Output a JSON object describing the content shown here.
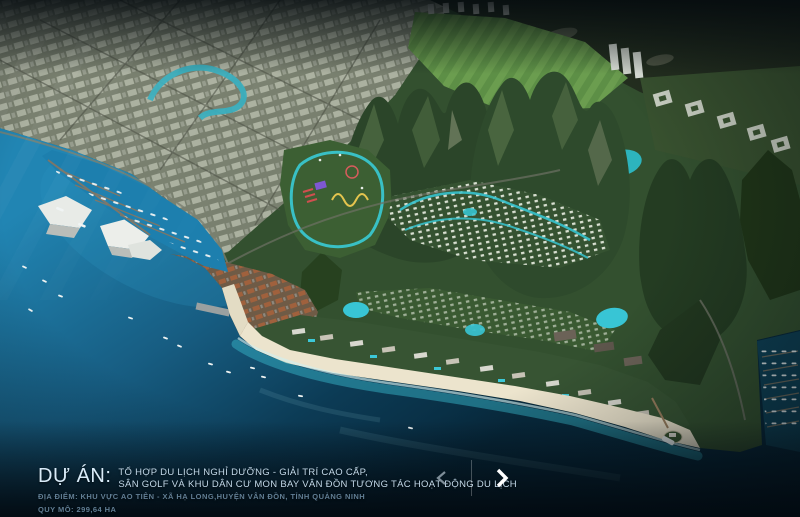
{
  "caption": {
    "project_label": "DỰ ÁN:",
    "project_title_line1": "TỔ HỢP DU LỊCH NGHỈ DƯỠNG - GIẢI TRÍ CAO CẤP,",
    "project_title_line2": "SÂN GOLF VÀ KHU DÂN CƯ MON BAY VÂN ĐỒN TƯƠNG TÁC HOẠT ĐỘNG DU LỊCH",
    "location_line": "ĐỊA ĐIỂM: KHU VỰC AO TIÊN - XÃ HẠ LONG,HUYỆN VÂN ĐỒN, TỈNH QUẢNG NINH",
    "area_line": "QUY MÔ: 299,64 HA"
  },
  "carousel": {
    "prev_icon": "chevron-left",
    "next_icon": "chevron-right"
  },
  "colors": {
    "ocean_bright": "#2185b3",
    "ocean_deep": "#0b3347",
    "shallow_water": "#35b2c6",
    "sand": "#ece4cd",
    "mountain_green": "#2b4529",
    "canal_teal": "#38c8d2",
    "caption_text": "#d9ebf8",
    "caption_dim_text": "#617e94",
    "arrow_active": "#ffffff",
    "arrow_inactive": "#7e8d98"
  }
}
